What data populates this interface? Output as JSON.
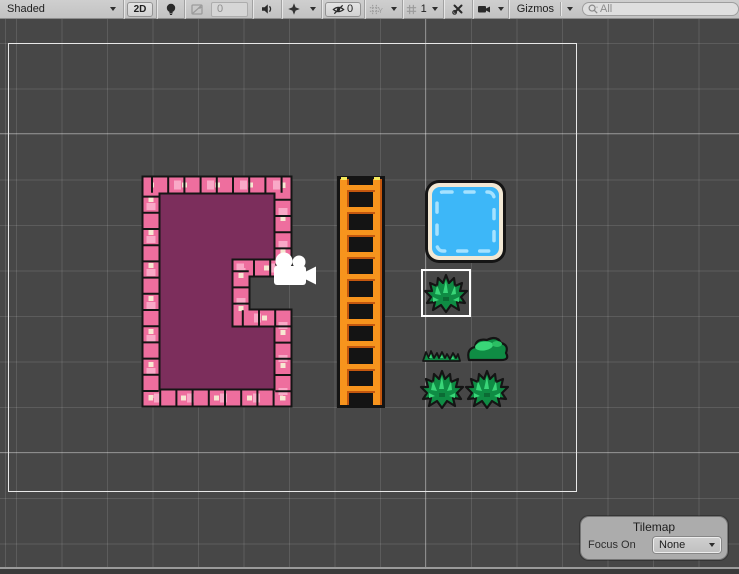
{
  "toolbar": {
    "shading_dropdown": "Shaded",
    "mode_2d_label": "2D",
    "exposure_value": "0",
    "hidden_objects_count": "0",
    "grid_axis_letter": "Y",
    "grid_opacity_value": "1",
    "gizmos_label": "Gizmos",
    "search_placeholder": "All"
  },
  "tilemap_overlay": {
    "title": "Tilemap",
    "focus_on_label": "Focus On",
    "focus_on_value": "None"
  },
  "scene": {
    "objects": [
      "dungeon-room-tilemap",
      "ladder-sprite",
      "water-tile-sprite",
      "selected-bush-tile",
      "grass-tuft-sprite",
      "mound-bush-sprite",
      "spiky-bush-sprite",
      "spiky-bush-sprite",
      "camera-gizmo"
    ],
    "colors": {
      "background": "#474747",
      "grid_line": "#5B5B5B",
      "camera_bounds": "#E8E8E8",
      "wall_pink": "#EE6E9E",
      "wall_light_pink": "#F9AFCB",
      "wall_highlight_cream": "#F7E7D2",
      "room_interior": "#7C2E5C",
      "ladder_orange": "#F7941D",
      "ladder_shadow": "#C4570E",
      "ladder_tip_yellow": "#F6E95A",
      "water_blue": "#3DB7F8",
      "water_highlight": "#A5E2FF",
      "water_border_cream": "#F2E8D4",
      "bush_green": "#0F8C44",
      "bush_light_green": "#39D678",
      "selection_box": "#FFFFFF",
      "camera_gizmo": "#FFFFFF",
      "toolbar_bg": "#C9C9C9"
    },
    "icons": [
      "lightbulb-icon",
      "exposure-icon",
      "audio-icon",
      "effects-icon",
      "eye-slash-icon",
      "grid-axis-icon",
      "grid-opacity-icon",
      "tools-icon",
      "camera-icon",
      "search-icon"
    ]
  }
}
